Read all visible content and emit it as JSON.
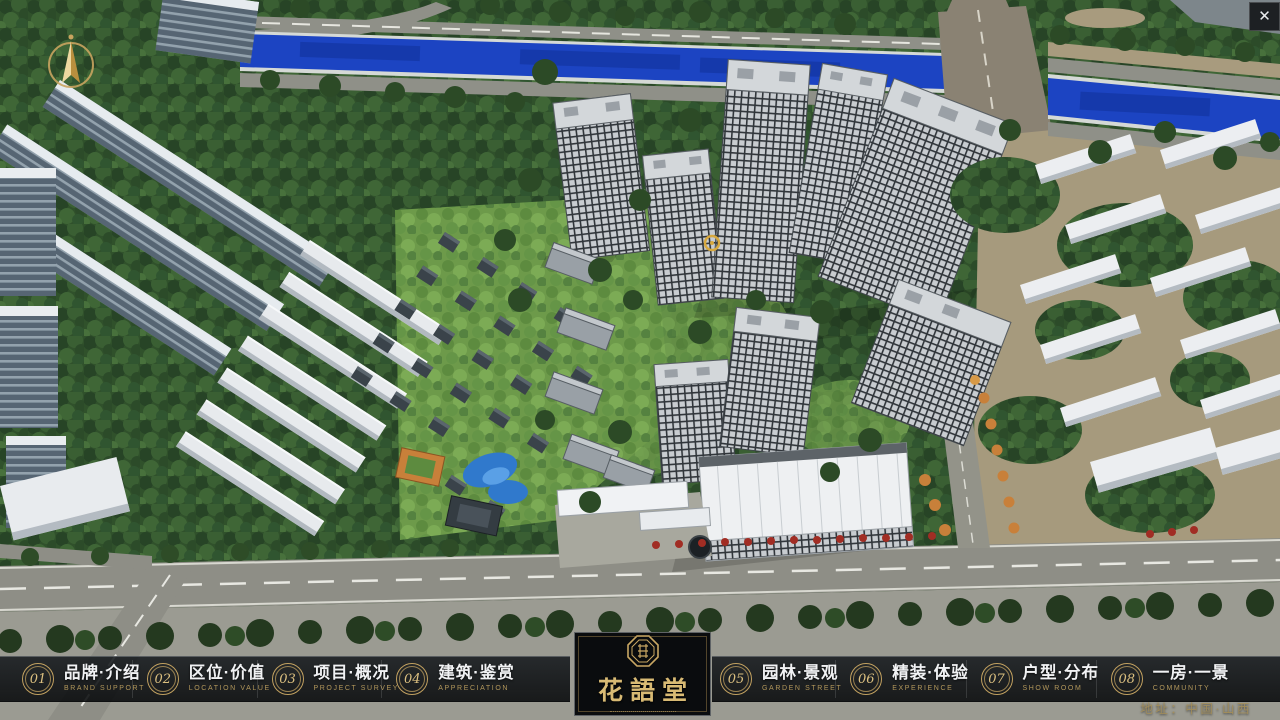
{
  "window": {
    "close_glyph": "✕"
  },
  "logo": {
    "name": "花語堂"
  },
  "nav": {
    "items": [
      {
        "num": "01",
        "zh": "品牌·介绍",
        "en": "BRAND SUPPORT"
      },
      {
        "num": "02",
        "zh": "区位·价值",
        "en": "LOCATION VALUE"
      },
      {
        "num": "03",
        "zh": "项目·概况",
        "en": "PROJECT SURVEY"
      },
      {
        "num": "04",
        "zh": "建筑·鉴赏",
        "en": "APPRECIATION"
      },
      {
        "num": "05",
        "zh": "园林·景观",
        "en": "GARDEN STREET"
      },
      {
        "num": "06",
        "zh": "精装·体验",
        "en": "EXPERIENCE"
      },
      {
        "num": "07",
        "zh": "户型·分布",
        "en": "SHOW ROOM"
      },
      {
        "num": "08",
        "zh": "一房·一景",
        "en": "COMMUNITY"
      }
    ]
  },
  "footer": {
    "address": "地址：中国·山西"
  },
  "scene": {
    "type": "3d-aerial-masterplan-render",
    "river_color": "#1c44c2",
    "foliage_color": "#30512b",
    "road_color": "#8e8e86",
    "ground_color": "#a69a7d",
    "tower_color": "#c8ccd0",
    "accent_gold": "#c9a45f"
  }
}
